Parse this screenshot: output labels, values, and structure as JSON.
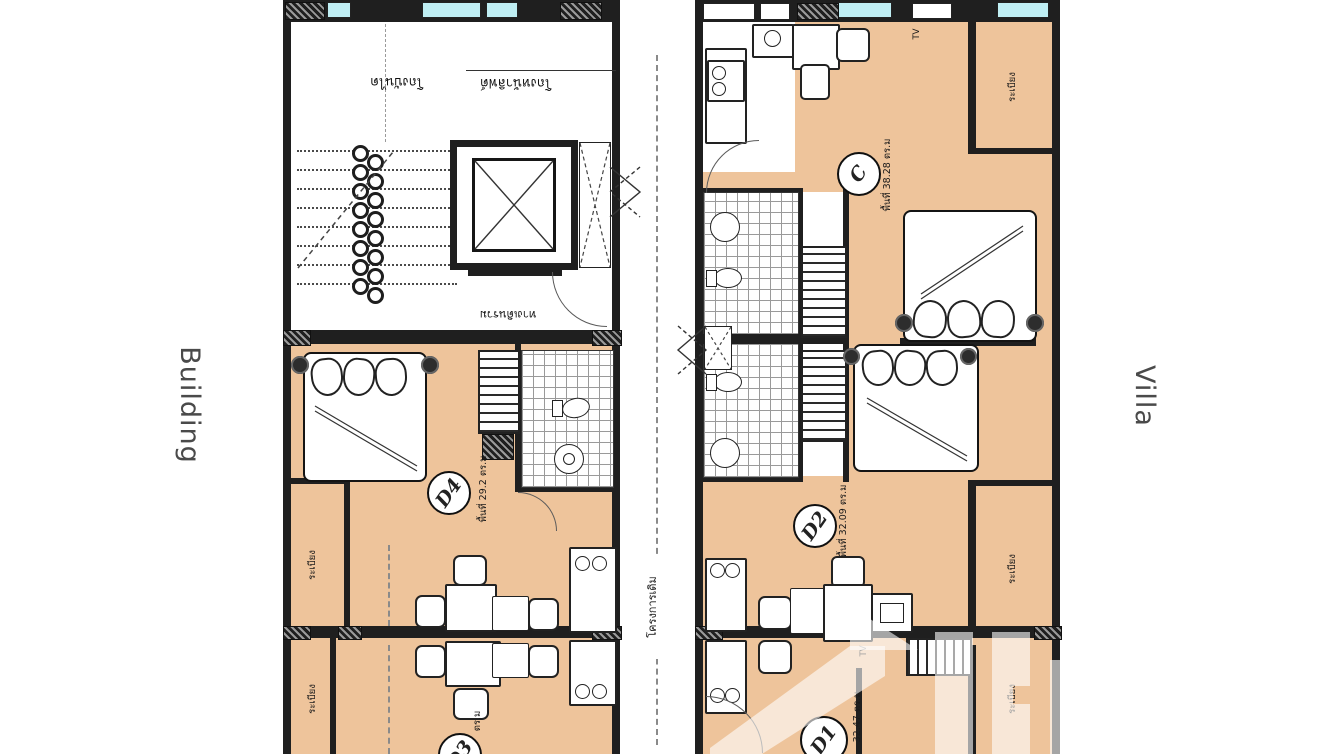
{
  "side_labels": {
    "left": "Building",
    "right": "Villa"
  },
  "divider": {
    "label": "โครงการเดิม"
  },
  "building": {
    "hall": {
      "stair_hall": "โถงบันได",
      "lift_hall": "โถงหน้าลิฟต์",
      "corridor": "ทางเดินรวม"
    },
    "units": {
      "d4": {
        "id": "D4",
        "area": "พื้นที่ 29.2 ตร.ม"
      },
      "d3": {
        "id": "D3",
        "area": "ตร.ม"
      }
    },
    "balconies": {
      "mid": "ระเบียง",
      "bottom": "ระเบียง"
    }
  },
  "villa": {
    "units": {
      "c": {
        "id": "C",
        "area": "พื้นที่ 38.28 ตร.ม"
      },
      "d2": {
        "id": "D2",
        "area": "พื้นที่ 32.09 ตร.ม"
      },
      "d1": {
        "id": "D1",
        "area": "32.47 ตร.ม"
      }
    },
    "balconies": {
      "top": "ระเบียง",
      "mid": "ระเบียง",
      "bottom": "ระเบียง"
    },
    "tv": {
      "top": "TV",
      "bottom": "TV"
    }
  },
  "colors": {
    "floor": "#eec49b",
    "wall": "#1f1f1f",
    "window": "#bfeef3",
    "label_text": "#4a4a4a"
  }
}
